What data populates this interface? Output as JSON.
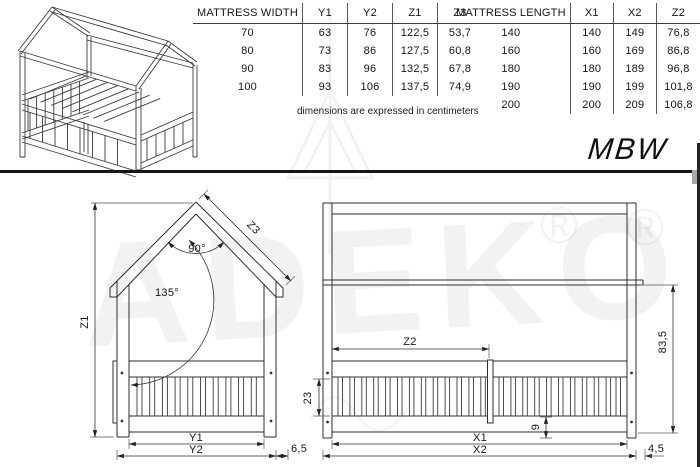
{
  "product": {
    "code": "MBW"
  },
  "note": "dimensions are expressed in centimeters",
  "width_table": {
    "headers": [
      "MATTRESS WIDTH",
      "Y1",
      "Y2",
      "Z1",
      "Z3"
    ],
    "rows": [
      [
        "70",
        "63",
        "76",
        "122,5",
        "53,7"
      ],
      [
        "80",
        "73",
        "86",
        "127,5",
        "60,8"
      ],
      [
        "90",
        "83",
        "96",
        "132,5",
        "67,8"
      ],
      [
        "100",
        "93",
        "106",
        "137,5",
        "74,9"
      ]
    ]
  },
  "length_table": {
    "headers": [
      "MATTRESS LENGTH",
      "X1",
      "X2",
      "Z2"
    ],
    "rows": [
      [
        "140",
        "140",
        "149",
        "76,8"
      ],
      [
        "160",
        "160",
        "169",
        "86,8"
      ],
      [
        "180",
        "180",
        "189",
        "96,8"
      ],
      [
        "190",
        "190",
        "199",
        "101,8"
      ],
      [
        "200",
        "200",
        "209",
        "106,8"
      ]
    ]
  },
  "front_view": {
    "height": "Z1",
    "roof_length": "Z3",
    "peak_angle": "90°",
    "eave_angle": "135°",
    "inner_width": "Y1",
    "outer_width": "Y2",
    "side_offset": "6,5"
  },
  "side_view": {
    "rail_section": "Z2",
    "slat_height": "23",
    "base_height": "9",
    "wall_height": "83,5",
    "inner_length": "X1",
    "outer_length": "X2",
    "roof_overhang": "4,5"
  },
  "watermark": {
    "brand": "ADEKO",
    "registered": "®"
  }
}
